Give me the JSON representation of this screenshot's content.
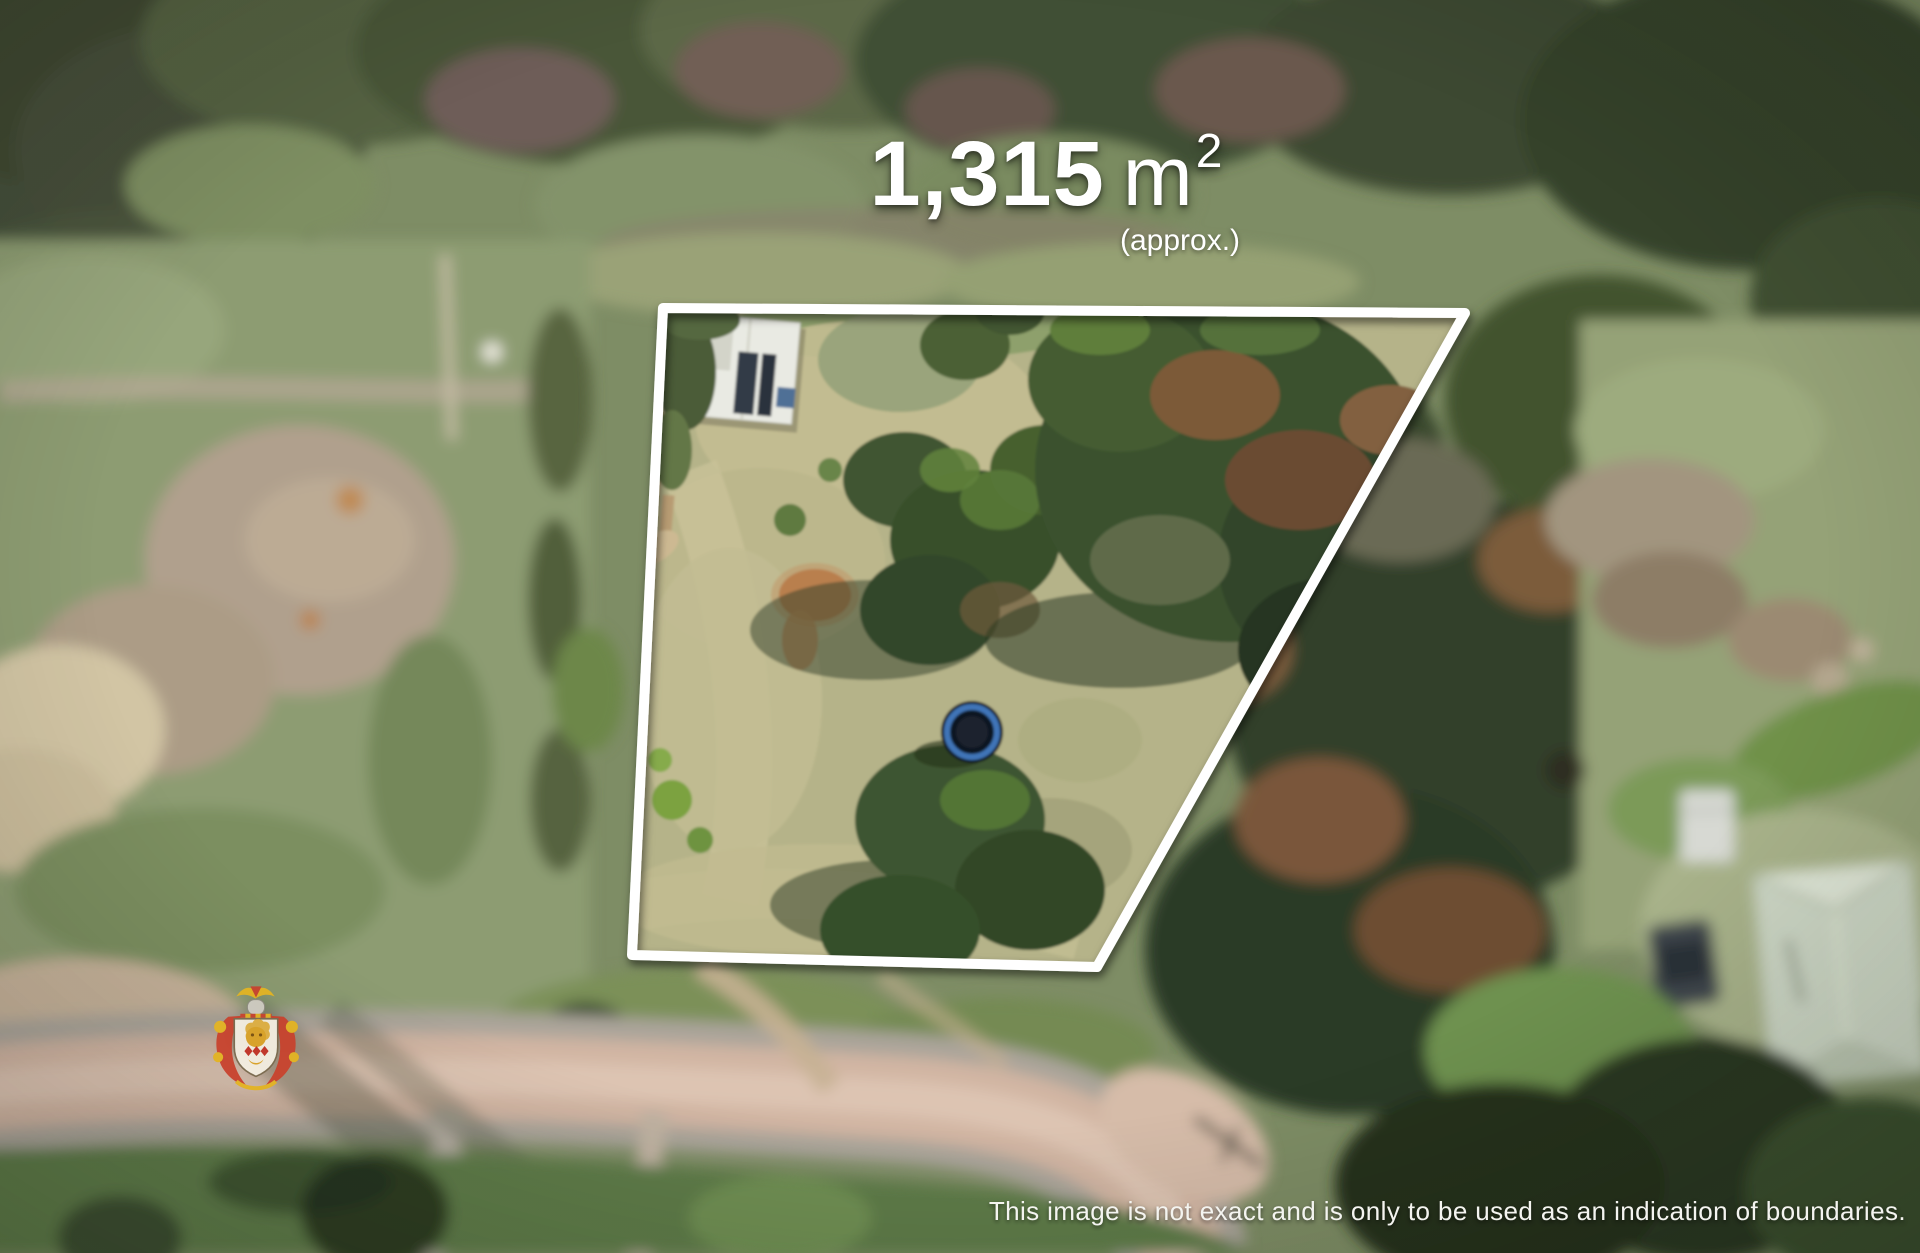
{
  "overlay": {
    "area_value": "1,315",
    "area_unit": "m",
    "area_exponent": "2",
    "area_qualifier": "(approx.)",
    "disclaimer": "This image is not exact and is only to be used as an indication of boundaries.",
    "text_color": "#ffffff"
  },
  "boundary": {
    "points": "663,308 1465,313 1097,967 632,955",
    "color": "#ffffff",
    "stroke_width": 10
  },
  "watermark": {
    "name": "heraldic-crest",
    "colors": {
      "red": "#c8432e",
      "gold": "#e3b422",
      "shield": "#f4efe2"
    }
  }
}
